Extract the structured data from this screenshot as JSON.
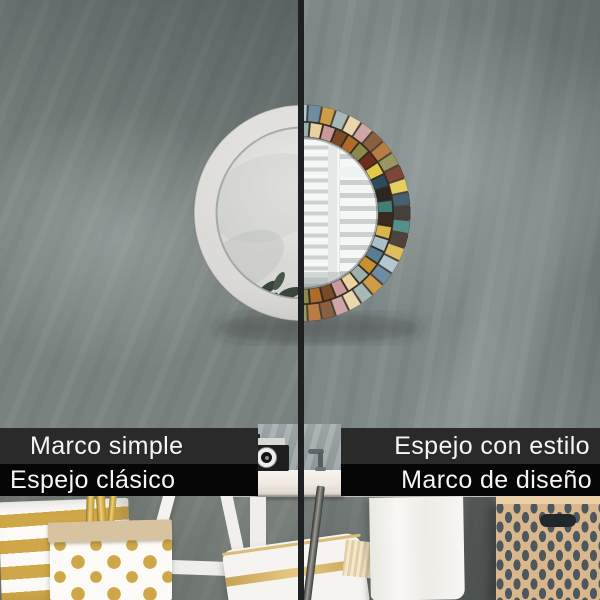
{
  "labels": {
    "left_top": "Marco simple",
    "left_bottom": "Espejo clásico",
    "right_top": "Espejo con estilo",
    "right_bottom": "Marco de diseño"
  },
  "theme": {
    "divider_color": "#1e2022",
    "bar_gray": "#2a2a2a",
    "bar_black": "#060606",
    "label_text": "#f6f6f6",
    "wall_left": "#79827f",
    "wall_right": "#7e8887"
  },
  "mirror": {
    "frame_plain_color": "#dbdad7",
    "glass_left_color": "#d7d8d5",
    "glass_right_color": "#dfe2e0",
    "mosaic_backing": "#352c22",
    "mosaic_palette": [
      "#d9b44a",
      "#7a4a26",
      "#3f7f78",
      "#e8d2a2",
      "#2e4a5e",
      "#c8902f",
      "#6e2c1e",
      "#a8c0cc",
      "#b06a2c",
      "#3a2a1e",
      "#c9999b",
      "#2c2620",
      "#9ab0ad",
      "#e3c84a",
      "#5a7d96",
      "#8a8a4a"
    ],
    "reflection": {
      "window_frame": "#e6e8e6",
      "window_slat": "#f5f7f6",
      "slat_base": "#cdd2d0"
    }
  },
  "scene": {
    "counter": "#efe9e2",
    "camera_body": "#1e1e1e",
    "camera_plate": "#d8d8d4",
    "gold": "#cfa648",
    "bag_white": "#fcfbf8",
    "bag_fold": "#d8c3a0",
    "pillow": "#f6f4f0",
    "towel": "#f7f6f3",
    "easel_white": "#f3f3f0",
    "rail_metal": "#4a4a48",
    "box_base": "#d9b78c",
    "box_pattern": "#4d585e"
  }
}
